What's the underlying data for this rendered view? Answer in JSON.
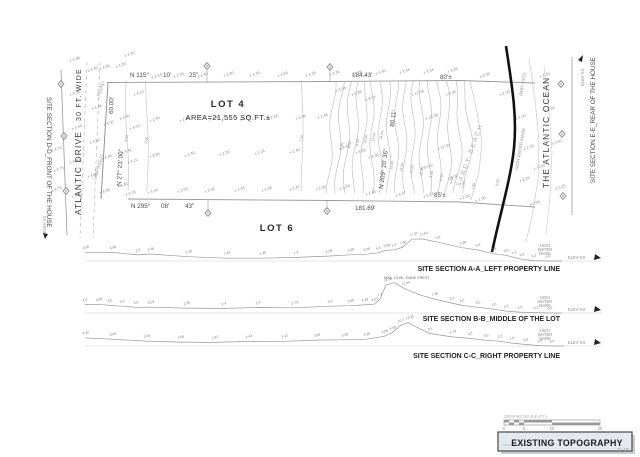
{
  "plan": {
    "left_section_label": "SITE SECTION D-D_FRONT OF THE HOUSE",
    "right_section_label": "SITE SECTION E-E_REAR OF THE HOUSE",
    "street_name": "ATLANTIC DRIVE",
    "street_width": "30 FT. WIDE",
    "road_label_1": "ROAD",
    "road_label_2": "UNPAVED",
    "ocean_label": "THE ATLANTIC OCEAN",
    "beach_label": "SANDY BEACH",
    "water_line_label": "HIGH WATER MARK",
    "water_line_date": "(MAY 2022)",
    "elev_zero_left": "ELEV 0.0",
    "elev_zero_right": "ELEV 0.0",
    "lot4": {
      "name": "LOT 4",
      "area": "AREA=21,555 SQ.FT.±"
    },
    "lot6": {
      "name": "LOT 6"
    },
    "bearings": {
      "north_1": "N 115°",
      "north_2": "10'",
      "north_3": "25\"",
      "south_1": "N 295°",
      "south_2": "08'",
      "south_3": "43\"",
      "west_dim": "60.00'",
      "west_bearing": "N 27° 23' 00\"",
      "east_bearing": "N 209° 20' 36\"",
      "east_dim": "80.11'",
      "north_len": "184.43'",
      "north_beach": "80'±",
      "south_len": "181.69'",
      "south_beach": "85'±"
    },
    "contour_labels": [
      [
        "5.00",
        342,
        150
      ],
      [
        "6.00",
        350,
        148
      ],
      [
        "8.00",
        358,
        146
      ],
      [
        "10.00",
        366,
        144
      ],
      [
        "12.00",
        374,
        142
      ],
      [
        "14.00",
        382,
        140
      ],
      [
        "15.00",
        392,
        170
      ],
      [
        "14.00",
        402,
        172
      ],
      [
        "12.00",
        412,
        174
      ],
      [
        "10.00",
        422,
        176
      ],
      [
        "8.00",
        432,
        178
      ],
      [
        "6.00",
        442,
        181
      ],
      [
        "4.00",
        452,
        184
      ],
      [
        "2.00",
        464,
        188
      ],
      [
        "1.00",
        474,
        190
      ],
      [
        "0.00",
        498,
        186
      ],
      [
        "4.00",
        127,
        142
      ],
      [
        "3.00",
        147,
        144
      ],
      [
        "2.00",
        302,
        142
      ]
    ],
    "spot_elevations": [
      [
        125,
        57,
        "4.45"
      ],
      [
        70,
        62,
        "4.46"
      ],
      [
        70,
        96,
        "4.38"
      ],
      [
        72,
        130,
        "4.44"
      ],
      [
        70,
        164,
        "4.40"
      ],
      [
        72,
        198,
        "4.60"
      ],
      [
        52,
        152,
        "4.73"
      ],
      [
        54,
        172,
        "4.75"
      ],
      [
        52,
        192,
        "4.78"
      ],
      [
        88,
        72,
        "4.45"
      ],
      [
        100,
        70,
        "4.36"
      ],
      [
        116,
        68,
        "4.29"
      ],
      [
        92,
        110,
        "4.48"
      ],
      [
        90,
        144,
        "4.52"
      ],
      [
        88,
        178,
        "4.56"
      ],
      [
        104,
        126,
        "4.50"
      ],
      [
        102,
        160,
        "4.46"
      ],
      [
        100,
        194,
        "4.56"
      ],
      [
        120,
        120,
        "4.40"
      ],
      [
        122,
        154,
        "4.42"
      ],
      [
        118,
        188,
        "4.46"
      ],
      [
        134,
        96,
        "4.20"
      ],
      [
        130,
        130,
        "4.00"
      ],
      [
        128,
        164,
        "4.10"
      ],
      [
        126,
        196,
        "4.16"
      ],
      [
        152,
        79,
        "4.34"
      ],
      [
        174,
        78,
        "4.38"
      ],
      [
        198,
        78,
        "4.40"
      ],
      [
        224,
        77,
        "4.40"
      ],
      [
        250,
        77,
        "4.39"
      ],
      [
        278,
        77,
        "4.34"
      ],
      [
        306,
        77,
        "4.38"
      ],
      [
        330,
        76,
        "4.36"
      ],
      [
        352,
        76,
        "4.38"
      ],
      [
        376,
        75,
        "4.40"
      ],
      [
        400,
        74,
        "4.44"
      ],
      [
        424,
        74,
        "4.34"
      ],
      [
        448,
        73,
        "4.28"
      ],
      [
        150,
        122,
        "2.65"
      ],
      [
        180,
        122,
        "2.29"
      ],
      [
        210,
        121,
        "2.40"
      ],
      [
        240,
        121,
        "2.29"
      ],
      [
        268,
        120,
        "2.24"
      ],
      [
        296,
        120,
        "2.46"
      ],
      [
        318,
        119,
        "2.46"
      ],
      [
        150,
        158,
        "2.60"
      ],
      [
        185,
        157,
        "2.40"
      ],
      [
        220,
        156,
        "2.30"
      ],
      [
        255,
        155,
        "2.34"
      ],
      [
        290,
        154,
        "2.40"
      ],
      [
        148,
        194,
        "3.50"
      ],
      [
        178,
        193,
        "3.05"
      ],
      [
        205,
        193,
        "3.02"
      ],
      [
        235,
        192,
        "3.44"
      ],
      [
        262,
        192,
        "3.44"
      ],
      [
        290,
        191,
        "3.47"
      ],
      [
        316,
        191,
        "3.06"
      ],
      [
        340,
        190,
        "3.28"
      ],
      [
        336,
        92,
        "4.54"
      ],
      [
        352,
        96,
        "5.98"
      ],
      [
        366,
        101,
        "8.01"
      ],
      [
        340,
        150,
        "4.47"
      ],
      [
        356,
        154,
        "6.02"
      ],
      [
        369,
        159,
        "8.00"
      ],
      [
        412,
        96,
        "12.08"
      ],
      [
        426,
        120,
        "14.08"
      ],
      [
        438,
        150,
        "12.05"
      ],
      [
        421,
        170,
        "10.02"
      ],
      [
        446,
        96,
        "8.08"
      ],
      [
        448,
        180,
        "8.06"
      ],
      [
        366,
        196,
        "4.40"
      ],
      [
        396,
        197,
        "4.37"
      ],
      [
        424,
        198,
        "3.28"
      ],
      [
        460,
        200,
        "2.28"
      ],
      [
        476,
        202,
        "1.05"
      ],
      [
        480,
        78,
        "4.08"
      ],
      [
        500,
        96,
        "2.05"
      ],
      [
        516,
        120,
        "1.05"
      ],
      [
        524,
        150,
        "1.00"
      ],
      [
        520,
        182,
        "0.25"
      ],
      [
        530,
        206,
        "0.05"
      ],
      [
        545,
        112,
        "1.03"
      ],
      [
        540,
        78,
        "3.05"
      ],
      [
        534,
        170,
        "-0.50"
      ],
      [
        552,
        145,
        "0.50"
      ],
      [
        556,
        190,
        "0.25"
      ]
    ]
  },
  "sections": [
    {
      "label": "SITE SECTION A-A_LEFT PROPERTY LINE",
      "baseline": 261,
      "hwm_lines": [
        "HIGH",
        "WATER",
        "MARK"
      ],
      "elev_label": "ELEV 0.0",
      "points": [
        [
          85,
          4.56,
          "4.56"
        ],
        [
          112,
          4.5,
          "4.50"
        ],
        [
          138,
          3.2,
          "3.2"
        ],
        [
          150,
          3.66,
          "3.66"
        ],
        [
          188,
          2.28,
          "2.28"
        ],
        [
          226,
          1.49,
          "1.49"
        ],
        [
          262,
          1.45,
          "1.45"
        ],
        [
          296,
          1.9,
          "1.9"
        ],
        [
          328,
          2.58,
          "2.58"
        ],
        [
          350,
          3.28,
          "3.28"
        ],
        [
          366,
          3.55,
          "3.55"
        ],
        [
          378,
          4.3,
          "4.3"
        ],
        [
          386,
          5.56,
          "5.56"
        ],
        [
          394,
          5.9,
          "5.9"
        ],
        [
          402,
          7.08,
          "7.08"
        ],
        [
          412,
          11.47,
          "11.47"
        ],
        [
          422,
          11.63,
          "11.63"
        ],
        [
          438,
          9.9,
          "9.9"
        ],
        [
          462,
          6.98,
          "6.98"
        ],
        [
          478,
          5.8,
          "5.8"
        ],
        [
          494,
          3.8,
          "3.8"
        ],
        [
          506,
          3.0,
          "3.0"
        ],
        [
          514,
          1.9,
          "1.9"
        ],
        [
          522,
          0.9,
          "0.9"
        ],
        [
          534,
          0.2,
          "0.2"
        ],
        [
          548,
          0.0,
          "0.0"
        ],
        [
          562,
          0.0,
          ""
        ]
      ]
    },
    {
      "label": "SITE SECTION B-B_MIDDLE OF THE LOT",
      "baseline": 313,
      "hwm_lines": [
        "HIGH",
        "WATER",
        "MARK"
      ],
      "elev_label": "ELEV 0.0",
      "crest_note": "MAX. 15.95 - DUNE CREST",
      "crest_x": 384,
      "crest_h": 34,
      "points": [
        [
          85,
          4.4,
          "4.4"
        ],
        [
          98,
          4.56,
          "4.56"
        ],
        [
          110,
          4.0,
          "4.0"
        ],
        [
          122,
          3.6,
          "3.6"
        ],
        [
          136,
          3.0,
          "3.0"
        ],
        [
          150,
          3.03,
          "3.03"
        ],
        [
          186,
          2.58,
          "2.58"
        ],
        [
          224,
          2.4,
          "2.4"
        ],
        [
          258,
          2.9,
          "2.9"
        ],
        [
          294,
          2.74,
          "2.74"
        ],
        [
          330,
          3.6,
          "3.6"
        ],
        [
          350,
          3.85,
          "3.85"
        ],
        [
          364,
          4.28,
          "4.28"
        ],
        [
          374,
          4.57,
          "4.57"
        ],
        [
          380,
          7.2,
          "7.2"
        ],
        [
          386,
          14.78,
          "14.78"
        ],
        [
          394,
          15.95,
          ""
        ],
        [
          404,
          12.99,
          "12.99"
        ],
        [
          420,
          9.5,
          ""
        ],
        [
          434,
          7.38,
          "7.38"
        ],
        [
          452,
          5.2,
          "5.2"
        ],
        [
          462,
          4.0,
          "4.0"
        ],
        [
          478,
          3.0,
          "3.0"
        ],
        [
          494,
          2.0,
          "2.0"
        ],
        [
          506,
          1.0,
          "1.0"
        ],
        [
          520,
          0.5,
          "0.5"
        ],
        [
          536,
          0.2,
          "0.2"
        ],
        [
          550,
          0.0,
          "0.0"
        ],
        [
          562,
          0.0,
          ""
        ]
      ]
    },
    {
      "label": "SITE SECTION C-C_RIGHT PROPERTY LINE",
      "baseline": 346,
      "hwm_lines": [
        "HIGH",
        "WATER",
        "MARK"
      ],
      "elev_label": "ELEV 0.0",
      "points": [
        [
          85,
          4.26,
          "4.26"
        ],
        [
          112,
          3.6,
          "3.60"
        ],
        [
          146,
          2.6,
          "2.60"
        ],
        [
          180,
          2.05,
          "2.05"
        ],
        [
          214,
          1.87,
          "1.87"
        ],
        [
          248,
          2.44,
          "2.44"
        ],
        [
          284,
          2.47,
          "2.47"
        ],
        [
          316,
          3.09,
          "3.09"
        ],
        [
          344,
          3.28,
          "3.28"
        ],
        [
          366,
          3.59,
          "3.59"
        ],
        [
          384,
          5.06,
          "5.06"
        ],
        [
          392,
          6.95,
          "6.95"
        ],
        [
          400,
          10.7,
          "10.7"
        ],
        [
          408,
          12.35,
          "12.35"
        ],
        [
          420,
          9.0,
          ""
        ],
        [
          430,
          6.6,
          "6.6"
        ],
        [
          452,
          4.79,
          "4.79"
        ],
        [
          470,
          4.0,
          "4.0"
        ],
        [
          486,
          3.0,
          "3.0"
        ],
        [
          500,
          2.5,
          "2.5"
        ],
        [
          512,
          1.5,
          "1.5"
        ],
        [
          526,
          0.8,
          "0.8"
        ],
        [
          540,
          0.2,
          "0.2"
        ],
        [
          552,
          0.0,
          "0.0"
        ],
        [
          564,
          0.0,
          ""
        ]
      ]
    }
  ],
  "footer": {
    "scale_label": "GRAPHIC SCALE (FT.)",
    "scale_ticks": [
      "0",
      "5",
      "10",
      "20"
    ],
    "title": "EXISTING TOPOGRAPHY",
    "title_note": "1\"=10'"
  },
  "colors": {
    "line": "#9a9a9a",
    "contour": "#b8b8b8",
    "water_line": "#111111",
    "title_fill": "#e3e9ee",
    "title_shadow": "#c7ccd1"
  }
}
